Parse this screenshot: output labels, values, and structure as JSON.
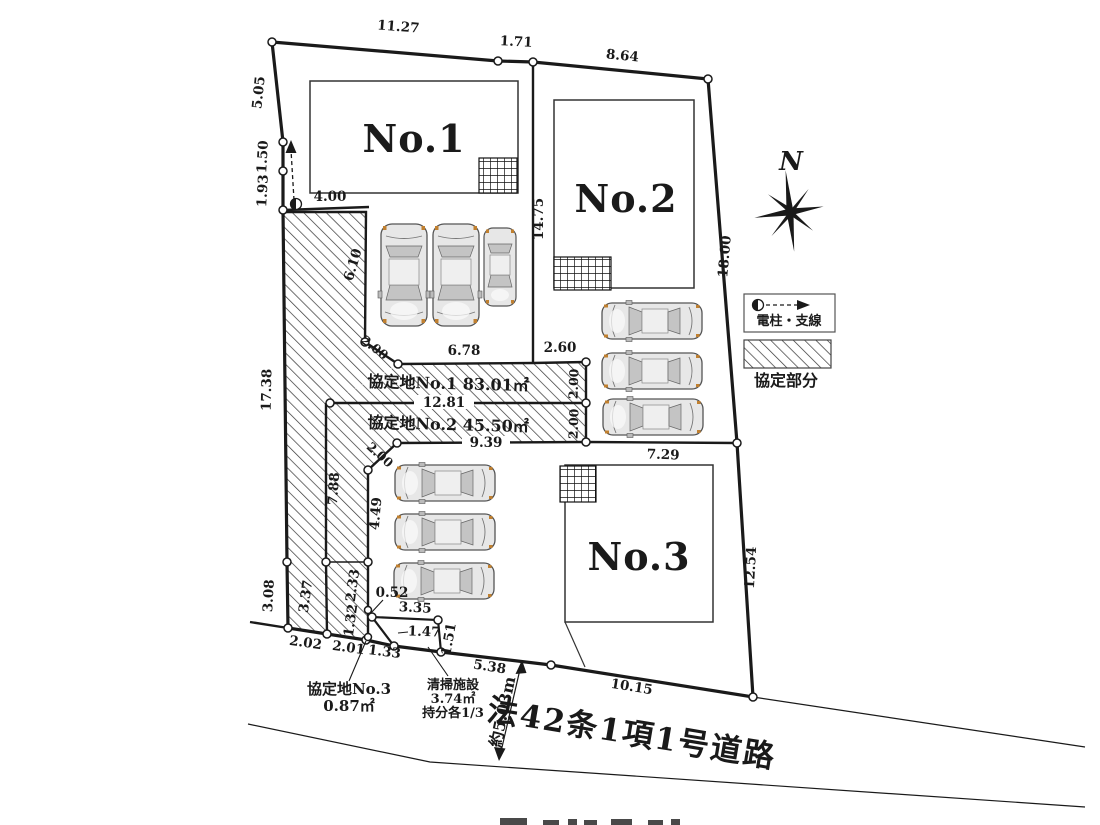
{
  "lots": {
    "no1": "No.1",
    "no2": "No.2",
    "no3": "No.3"
  },
  "dims": {
    "v11_27": "11.27",
    "v1_71": "1.71",
    "v8_64": "8.64",
    "v5_05": "5.05",
    "v1_50": "1.50",
    "v1_93": "1.93",
    "v17_38": "17.38",
    "v3_08": "3.08",
    "v4_00": "4.00",
    "v6_10": "6.10",
    "v2_00": "2.00",
    "v7_88": "7.88",
    "v4_49": "4.49",
    "v3_37": "3.37",
    "v2_33": "2.33",
    "v1_32": "1.32",
    "v0_52": "0.52",
    "v3_35": "3.35",
    "v1_47": "1.47",
    "v1_33": "1.33",
    "v1_51": "1.51",
    "v2_02": "2.02",
    "v2_01": "2.01",
    "v6_78": "6.78",
    "v2_60": "2.60",
    "v12_81": "12.81",
    "v9_39": "9.39",
    "v14_75": "14.75",
    "v18_00": "18.00",
    "v12_54": "12.54",
    "v7_29": "7.29",
    "v10_15": "10.15",
    "v5_38": "5.38"
  },
  "areas": {
    "kyotei1": "協定地No.1 83.01㎡",
    "kyotei2": "協定地No.2 45.50㎡",
    "kyotei3_name": "協定地No.3",
    "kyotei3_area": "0.87㎡",
    "cleaning_name": "清掃施設",
    "cleaning_area": "3.74㎡",
    "cleaning_share": "持分各1/3"
  },
  "road": {
    "name": "法42条1項1号道路",
    "width": "約5.03m"
  },
  "legend": {
    "north": "N",
    "pole": "電柱・支線",
    "agreement": "協定部分"
  },
  "colors": {
    "ink": "#1a1a1a",
    "paper": "#ffffff",
    "car_body": "#e7e7e7",
    "glass": "#c4c4c4",
    "marker_orange": "#c08030"
  }
}
